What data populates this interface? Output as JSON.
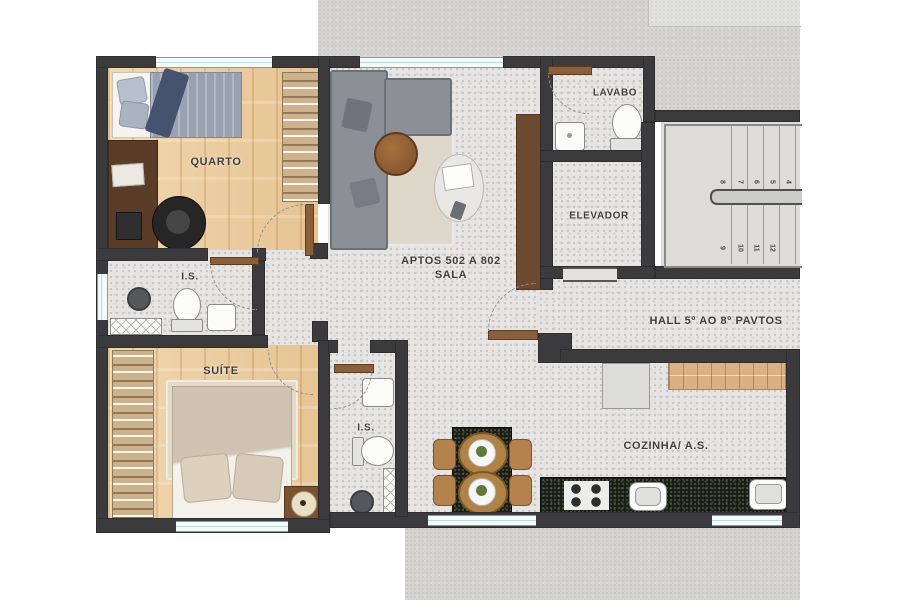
{
  "labels": {
    "quarto": "QUARTO",
    "lavabo": "LAVABO",
    "elevador": "ELEVADOR",
    "sala_line1": "APTOS 502 A 802",
    "sala_line2": "SALA",
    "hall": "HALL 5º AO 8º PAVTOS",
    "is_social": "I.S.",
    "suite": "SUÍTE",
    "is_suite": "I.S.",
    "cozinha": "COZINHA/ A.S."
  },
  "stairs": {
    "upper_flight_numbers": [
      "8",
      "7",
      "6",
      "5",
      "4"
    ],
    "lower_flight_numbers": [
      "9",
      "10",
      "11",
      "12"
    ]
  },
  "colors": {
    "wall": "#3b3b3d",
    "wood_floor": "#ecd0a6",
    "tile_floor": "#e6e5e3",
    "concrete": "#d5d4d1",
    "granite_counter": "#1a1e14",
    "window_glass": "#f3fafa",
    "door_wood": "#8a5f3a"
  }
}
